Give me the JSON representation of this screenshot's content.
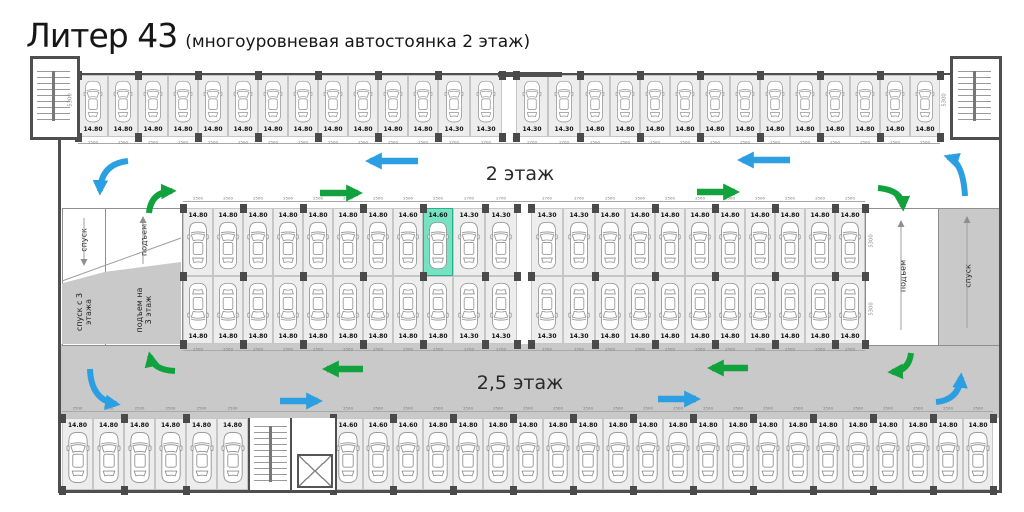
{
  "title": {
    "main": "Литер 43",
    "subtitle": "(многоуровневая автостоянка 2 этаж)"
  },
  "floors": {
    "second": "2 этаж",
    "second_half": "2,5 этаж"
  },
  "ramps": {
    "left_down": "спуск",
    "left_up": "подъем",
    "left_down_from3": "спуск с 3 этажа",
    "left_up_to3": "подъем на 3 этаж",
    "right_up": "подъем",
    "right_down": "спуск"
  },
  "dims": {
    "vertical": "5300"
  },
  "colors": {
    "blue_arrow": "#2c9fe2",
    "green_arrow": "#11a23e",
    "highlight_fill": "#75e3c2",
    "highlight_border": "#2fae8f",
    "aisle_gray": "#c9c9c9",
    "space_fill": "#ededed",
    "wall": "#4f4f4f",
    "car_stroke": "#8f8f8f"
  },
  "plan": {
    "bands": [
      {
        "name": "top-row",
        "x": 78,
        "y": 75,
        "h": 62,
        "labelSide": "bottom",
        "carRot": 0,
        "segments": [
          {
            "n": 12,
            "area": "14.80",
            "dim": "2500",
            "w": 30
          },
          {
            "n": 2,
            "area": "14.30",
            "dim": "2700",
            "w": 32
          },
          {
            "gap": true,
            "w": 14
          },
          {
            "n": 2,
            "area": "14.30",
            "dim": "2700",
            "w": 32
          },
          {
            "n": 12,
            "area": "14.80",
            "dim": "2500",
            "w": 30
          }
        ]
      },
      {
        "name": "mid-upper-row",
        "x": 183,
        "y": 208,
        "h": 68,
        "labelSide": "top",
        "carRot": 0,
        "segments": [
          {
            "n": 7,
            "area": "14.80",
            "dim": "2500",
            "w": 30
          },
          {
            "n": 1,
            "area": "14.60",
            "dim": "2500",
            "w": 30
          },
          {
            "n": 1,
            "area": "14.60",
            "dim": "2500",
            "w": 30,
            "highlight": true
          },
          {
            "n": 2,
            "area": "14.30",
            "dim": "2700",
            "w": 32
          },
          {
            "gap": true,
            "w": 14
          },
          {
            "n": 2,
            "area": "14.30",
            "dim": "2700",
            "w": 32
          },
          {
            "n": 9,
            "area": "14.80",
            "dim": "2500",
            "w": 30
          }
        ]
      },
      {
        "name": "mid-lower-row",
        "x": 183,
        "y": 276,
        "h": 68,
        "labelSide": "bottom",
        "carRot": 180,
        "segments": [
          {
            "n": 9,
            "area": "14.80",
            "dim": "2500",
            "w": 30
          },
          {
            "n": 2,
            "area": "14.30",
            "dim": "2700",
            "w": 32
          },
          {
            "gap": true,
            "w": 14
          },
          {
            "n": 2,
            "area": "14.30",
            "dim": "2700",
            "w": 32
          },
          {
            "n": 9,
            "area": "14.80",
            "dim": "2500",
            "w": 30
          }
        ]
      },
      {
        "name": "bottom-row",
        "x": 62,
        "y": 418,
        "h": 72,
        "labelSide": "top",
        "carRot": 0,
        "segments": [
          {
            "n": 6,
            "area": "14.80",
            "dim": "2500",
            "w": 31
          },
          {
            "stair": true,
            "w": 85
          },
          {
            "n": 3,
            "area": "14.60",
            "dim": "2500",
            "w": 30
          },
          {
            "n": 19,
            "area": "14.80",
            "dim": "2500",
            "w": 30
          }
        ]
      }
    ]
  }
}
